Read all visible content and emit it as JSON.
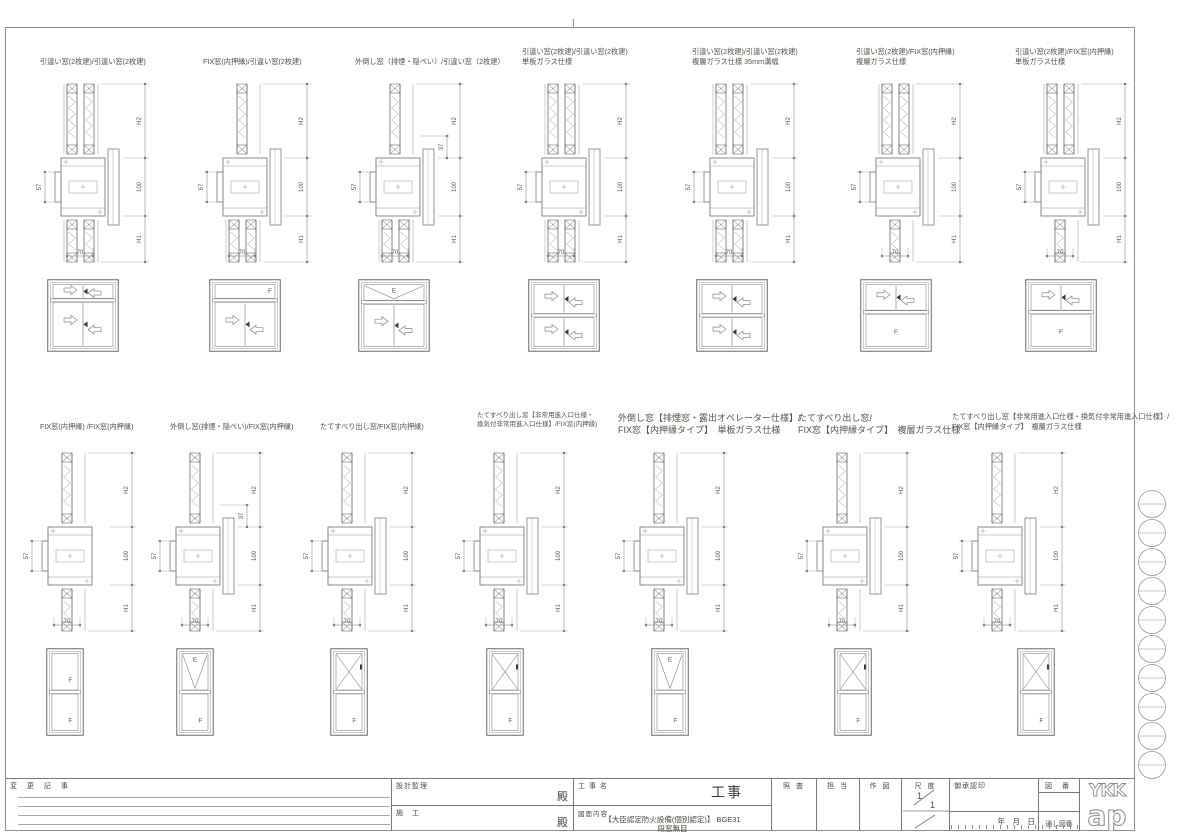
{
  "title_block": {
    "change_notes": "変 更 記 事",
    "design_supervision": "設計監理",
    "design_supervision_dono": "殿",
    "construction": "施　工",
    "construction_dono": "殿",
    "project_label": "工 事 名",
    "project_value": "工事",
    "content_label": "図面内容",
    "content_line1": "【大臣認定防火設備(個別認定)】 BGE31",
    "content_line2": "段窓無目",
    "col_check": "照 査",
    "col_charge": "担 当",
    "col_draw": "作 図",
    "scale_label": "尺 度",
    "scale_numerator": "1",
    "scale_denominator": "1",
    "approval_label": "御承認印",
    "date_label": "年　月　日",
    "serial_label": "通し図番",
    "drawing_no_label": "図 番",
    "logo_top": "YKK",
    "logo_bottom": "ap"
  },
  "rows": {
    "top": {
      "stations": [
        {
          "label_lines": [
            "引違い窓(2枚建)/引違い窓(2枚建)"
          ],
          "size": "m",
          "section": {
            "upper": "slider",
            "lower": "slider",
            "right_plate": true,
            "dims": {
              "side": "57",
              "upper": "H2",
              "mullion": "100",
              "lower": "H1",
              "width": "70"
            }
          },
          "elevation": {
            "bands": [
              {
                "type": "slide2",
                "hf": 0.27
              },
              {
                "type": "slide2",
                "hf": 0.73
              }
            ]
          }
        },
        {
          "label_lines": [
            "FIX窓(内押縁)/引違い窓(2枚建)"
          ],
          "size": "m",
          "section": {
            "upper": "fix",
            "lower": "slider",
            "right_plate": true,
            "dims": {
              "side": "57",
              "upper": "H2",
              "mullion": "100",
              "lower": "H1",
              "width": "70"
            }
          },
          "elevation": {
            "bands": [
              {
                "type": "fix",
                "label": "F",
                "label_pos": "right",
                "hf": 0.27
              },
              {
                "type": "slide2",
                "hf": 0.73
              }
            ]
          }
        },
        {
          "label_lines": [
            "外倒し窓（排煙・隠ぺい）/引違い窓（2枚建）"
          ],
          "size": "m",
          "section": {
            "upper": "tilt",
            "lower": "slider",
            "right_plate": true,
            "dims": {
              "side": "57",
              "upper": "H2",
              "mullion": "100",
              "lower": "H1",
              "width": "70",
              "extra": "37"
            }
          },
          "elevation": {
            "bands": [
              {
                "type": "tilt",
                "label": "E",
                "hf": 0.3
              },
              {
                "type": "slide2",
                "hf": 0.7
              }
            ]
          }
        },
        {
          "label_lines": [
            "引違い窓(2枚建)/引違い窓(2枚建)",
            "単板ガラス仕様"
          ],
          "size": "m",
          "section": {
            "upper": "slider",
            "lower": "slider",
            "right_plate": true,
            "dims": {
              "side": "57",
              "upper": "H2",
              "mullion": "100",
              "lower": "H1",
              "width": "70"
            }
          },
          "elevation": {
            "bands": [
              {
                "type": "slide2",
                "hf": 0.5
              },
              {
                "type": "slide2",
                "hf": 0.5
              }
            ]
          }
        },
        {
          "label_lines": [
            "引違い窓(2枚建)/引違い窓(2枚建)",
            "複層ガラス仕様 35mm溝幅"
          ],
          "size": "m",
          "section": {
            "upper": "slider",
            "lower": "slider",
            "right_plate": true,
            "dims": {
              "side": "57",
              "upper": "H2",
              "mullion": "100",
              "lower": "H1",
              "width": "70"
            }
          },
          "elevation": {
            "bands": [
              {
                "type": "slide2",
                "hf": 0.5
              },
              {
                "type": "slide2",
                "hf": 0.5
              }
            ]
          }
        },
        {
          "label_lines": [
            "引違い窓(2枚建)/FIX窓(内押縁)",
            "複層ガラス仕様"
          ],
          "size": "m",
          "section": {
            "upper": "slider",
            "lower": "fix",
            "right_plate": true,
            "dims": {
              "side": "57",
              "upper": "H2",
              "mullion": "100",
              "lower": "H1",
              "width": "70"
            }
          },
          "elevation": {
            "bands": [
              {
                "type": "slide2",
                "hf": 0.45
              },
              {
                "type": "fix",
                "label": "F",
                "hf": 0.55
              }
            ]
          }
        },
        {
          "label_lines": [
            "引違い窓(2枚建)/FIX窓(内押縁)",
            "単板ガラス仕様"
          ],
          "size": "m",
          "section": {
            "upper": "slider",
            "lower": "fix",
            "right_plate": true,
            "dims": {
              "side": "57",
              "upper": "H2",
              "mullion": "100",
              "lower": "H1",
              "width": "70"
            }
          },
          "elevation": {
            "bands": [
              {
                "type": "slide2",
                "hf": 0.45
              },
              {
                "type": "fix",
                "label": "F",
                "hf": 0.55
              }
            ]
          }
        }
      ]
    },
    "bottom": {
      "stations": [
        {
          "label_lines": [
            "FIX窓(内押縁) /FIX窓(内押縁)"
          ],
          "size": "m",
          "section": {
            "upper": "fix",
            "lower": "fix",
            "right_plate": false,
            "dims": {
              "side": "57",
              "upper": "H2",
              "mullion": "100",
              "lower": "H1",
              "width": "70"
            }
          },
          "elevation": {
            "bands": [
              {
                "type": "fix",
                "label": "F",
                "hf": 0.5
              },
              {
                "type": "fix",
                "label": "F",
                "hf": 0.5
              }
            ]
          }
        },
        {
          "label_lines": [
            "外倒し窓(排煙・隠ぺい)/FIX窓(内押縁)"
          ],
          "size": "m",
          "section": {
            "upper": "tilt",
            "lower": "fix",
            "right_plate": true,
            "dims": {
              "side": "57",
              "upper": "H2",
              "mullion": "100",
              "lower": "H1",
              "width": "70",
              "extra": "37"
            }
          },
          "elevation": {
            "bands": [
              {
                "type": "tilt",
                "label": "E",
                "hf": 0.5
              },
              {
                "type": "fix",
                "label": "F",
                "hf": 0.5
              }
            ]
          }
        },
        {
          "label_lines": [
            "たてすべり出し窓/FIX窓(内押縁)"
          ],
          "size": "m",
          "section": {
            "upper": "casement",
            "lower": "fix",
            "right_plate": true,
            "dims": {
              "side": "57",
              "upper": "H2",
              "mullion": "100",
              "lower": "H1",
              "width": "70"
            }
          },
          "elevation": {
            "bands": [
              {
                "type": "casement",
                "hf": 0.5
              },
              {
                "type": "fix",
                "label": "F",
                "hf": 0.5
              }
            ]
          }
        },
        {
          "label_lines": [
            "たてすべり出し窓【非常用進入口仕様・",
            "換気付非常用進入口仕様】/FIX窓(内押縁)"
          ],
          "size": "s",
          "section": {
            "upper": "casement",
            "lower": "fix",
            "right_plate": true,
            "dims": {
              "side": "57",
              "upper": "H2",
              "mullion": "100",
              "lower": "H1",
              "width": "70"
            }
          },
          "elevation": {
            "bands": [
              {
                "type": "casement",
                "hf": 0.5
              },
              {
                "type": "fix",
                "label": "F",
                "hf": 0.5
              }
            ]
          }
        },
        {
          "label_lines": [
            "外倒し窓【排煙窓・露出オペレーター仕様】/",
            "FIX窓【内押縁タイプ】　単板ガラス仕様"
          ],
          "size": "l",
          "section": {
            "upper": "tilt",
            "lower": "fix",
            "right_plate": true,
            "dims": {
              "side": "57",
              "upper": "H2",
              "mullion": "100",
              "lower": "H1",
              "width": "70"
            }
          },
          "elevation": {
            "bands": [
              {
                "type": "tilt",
                "label": "E",
                "hf": 0.5
              },
              {
                "type": "fix",
                "label": "F",
                "hf": 0.5
              }
            ]
          }
        },
        {
          "label_lines": [
            "たてすべり出し窓/",
            "FIX窓【内押縁タイプ】　複層ガラス仕様"
          ],
          "size": "l",
          "section": {
            "upper": "casement",
            "lower": "fix",
            "right_plate": true,
            "dims": {
              "side": "57",
              "upper": "H2",
              "mullion": "100",
              "lower": "H1",
              "width": "70"
            }
          },
          "elevation": {
            "bands": [
              {
                "type": "casement",
                "hf": 0.5
              },
              {
                "type": "fix",
                "label": "F",
                "hf": 0.5
              }
            ]
          }
        },
        {
          "label_lines": [
            "たてすべり出し窓【非常用進入口仕様・換気付非常用進入口仕様】/",
            "FIX窓【内押縁タイプ】　複層ガラス仕様"
          ],
          "size": "m",
          "section": {
            "upper": "casement",
            "lower": "fix",
            "right_plate": true,
            "dims": {
              "side": "57",
              "upper": "H2",
              "mullion": "100",
              "lower": "H1",
              "width": "70"
            }
          },
          "elevation": {
            "bands": [
              {
                "type": "casement",
                "hf": 0.5
              },
              {
                "type": "fix",
                "label": "F",
                "hf": 0.5
              }
            ]
          }
        }
      ]
    }
  }
}
